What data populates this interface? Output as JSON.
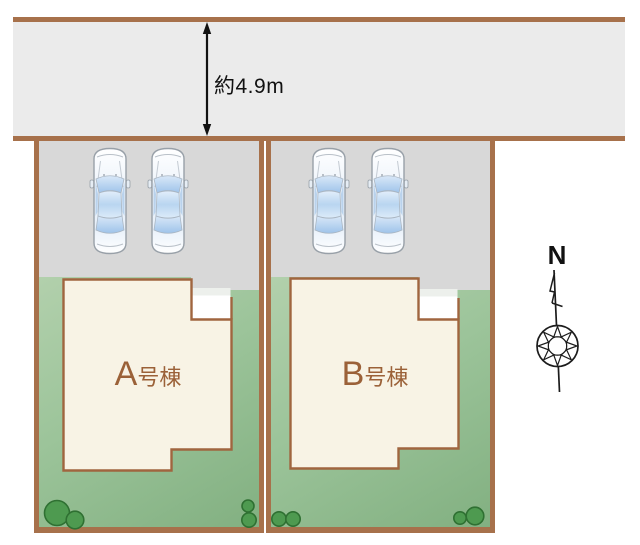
{
  "diagram": {
    "type": "residential-site-plan",
    "road": {
      "width_label": "約4.9m",
      "surface_color": "#ebebeb",
      "border_color": "#a7714b"
    },
    "lots": [
      {
        "name": "Lot A",
        "building_label": {
          "prefix": "A",
          "suffix": "号棟"
        },
        "parked_cars": 2,
        "bushes": 4
      },
      {
        "name": "Lot B",
        "building_label": {
          "prefix": "B",
          "suffix": "号棟"
        },
        "parked_cars": 2,
        "bushes": 4
      }
    ],
    "compass": {
      "north_label": "N"
    },
    "colors": {
      "lot_border": "#a7714b",
      "parking_gray": "#d8d8d8",
      "yard_green_light": "#b2d0ac",
      "yard_green_dark": "#82b081",
      "building_fill": "#f8f3e5",
      "building_outline": "#a0653f",
      "building_label": "#9b6138",
      "bush_fill": "#4e9a50",
      "bush_outline": "#2f7032",
      "car_glass_blue": "#9ec3ea"
    }
  }
}
